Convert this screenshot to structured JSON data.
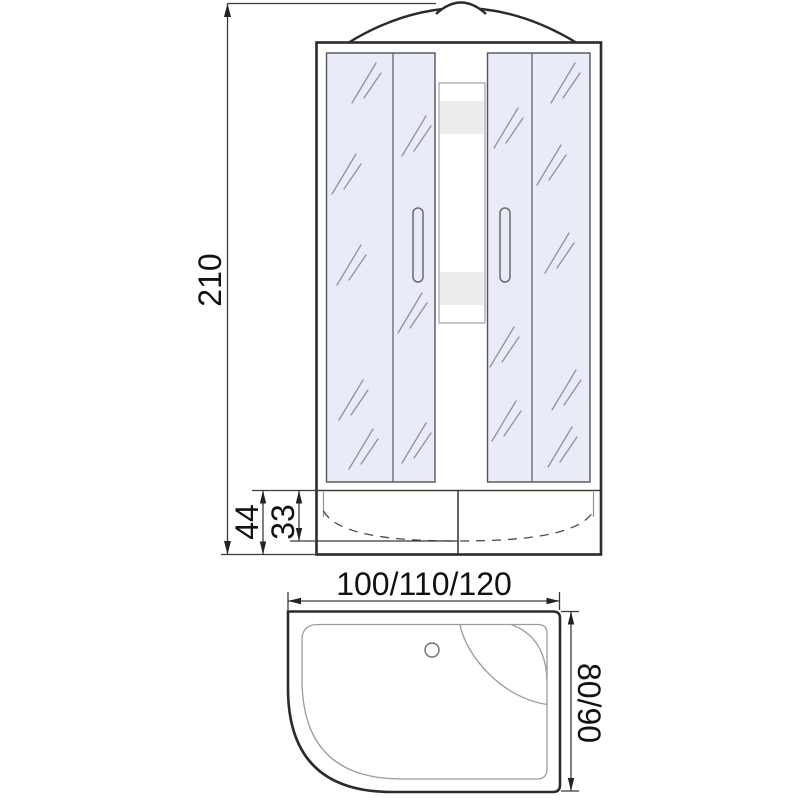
{
  "front_view": {
    "height_label": "210",
    "tray_height_label": "44",
    "tray_inner_height_label": "33"
  },
  "top_view": {
    "width_label": "100/110/120",
    "depth_label": "80/90"
  },
  "colors": {
    "line": "#2b2b2b",
    "dim_line": "#3a3a3a",
    "text": "#111111",
    "glass_fill": "#e9ecf7",
    "glass_hatch": "#8b90a9",
    "shelf_band": "#ededee",
    "background": "#ffffff"
  }
}
